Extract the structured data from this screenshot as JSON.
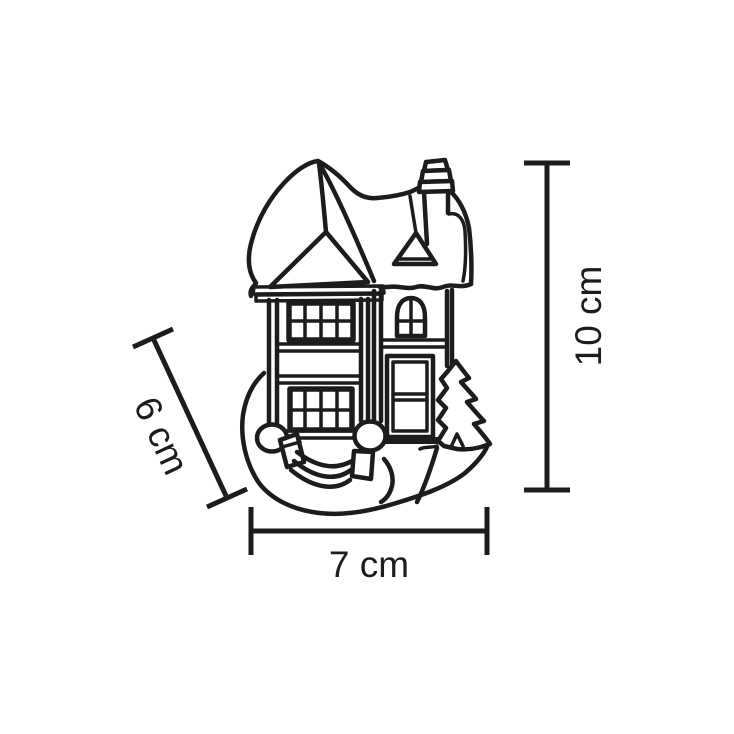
{
  "page": {
    "background_color": "#ffffff"
  },
  "drawing": {
    "subject": "miniature two-story cottage figurine line drawing",
    "line_color": "#1c1c1c",
    "fill_color": "#ffffff"
  },
  "dimensions": {
    "height": {
      "label": "10 cm",
      "orientation": "vertical-right"
    },
    "width": {
      "label": "7 cm",
      "orientation": "horizontal-bottom"
    },
    "depth": {
      "label": "6 cm",
      "orientation": "diagonal-left"
    }
  }
}
